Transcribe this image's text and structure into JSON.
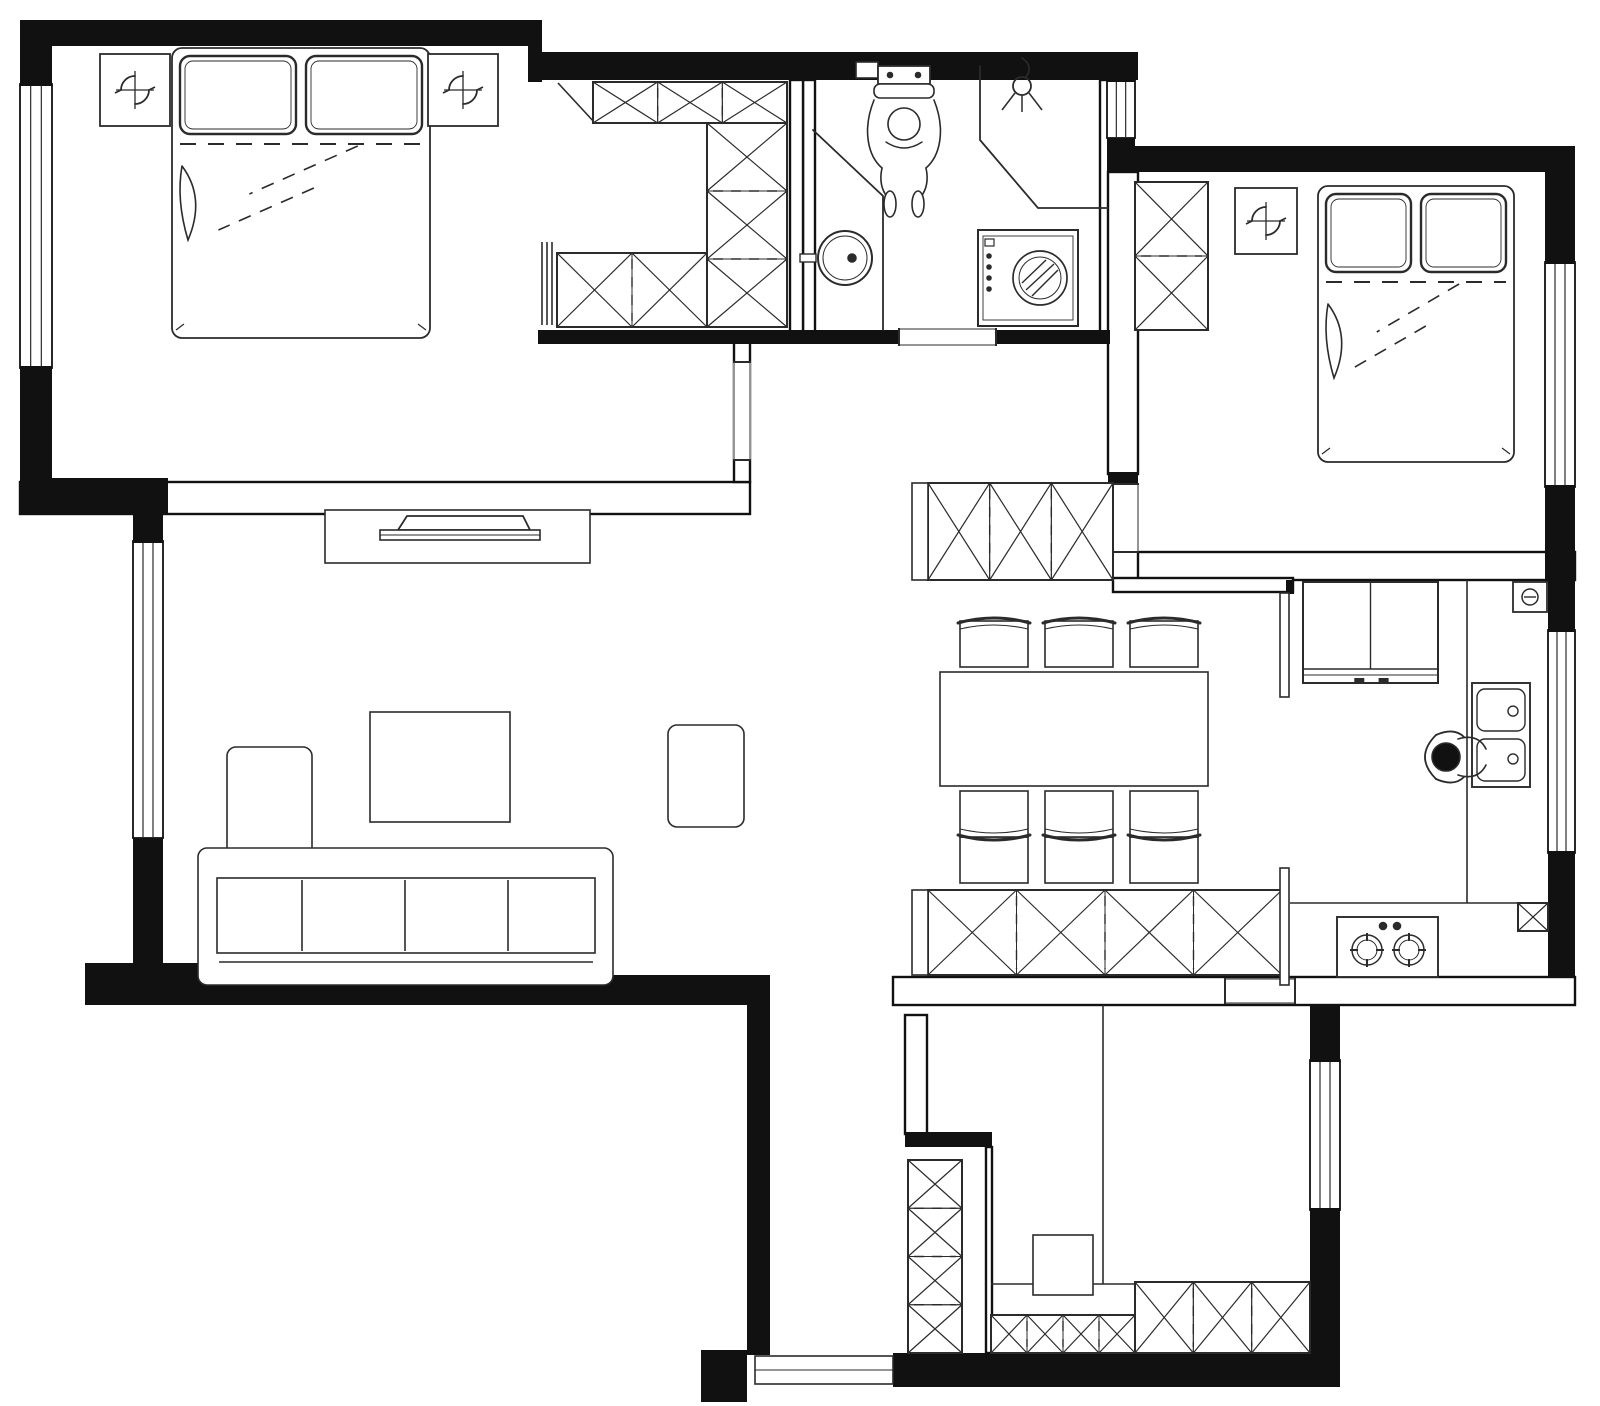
{
  "title": "apartment-floor-plan",
  "canvas": {
    "width": 1600,
    "height": 1406,
    "background": "#ffffff",
    "wall_color": "#111111",
    "line_color": "#2b2b2b",
    "sketch_color": "#333333"
  },
  "rooms": [
    {
      "name": "master-bedroom"
    },
    {
      "name": "walk-in-closet"
    },
    {
      "name": "bathroom"
    },
    {
      "name": "foyer"
    },
    {
      "name": "second-bedroom"
    },
    {
      "name": "living-room"
    },
    {
      "name": "dining-room"
    },
    {
      "name": "kitchen"
    },
    {
      "name": "corridor"
    },
    {
      "name": "study-room"
    }
  ],
  "elements": [
    {
      "n": "wall-bedroom1-south",
      "t": "hwall",
      "r": [
        20,
        482,
        730,
        32
      ]
    },
    {
      "n": "wall-bathroom-west",
      "t": "hwall",
      "r": [
        803,
        80,
        12,
        252
      ]
    },
    {
      "n": "wall-bathroom-east",
      "t": "hwall",
      "r": [
        1100,
        80,
        10,
        254
      ]
    },
    {
      "n": "wall-foyer-east",
      "t": "hwall",
      "r": [
        1108,
        172,
        30,
        302
      ]
    },
    {
      "n": "wall-bedroom2-south",
      "t": "hwall",
      "r": [
        1138,
        552,
        437,
        28
      ]
    },
    {
      "n": "wall-dining-north",
      "t": "hwall",
      "r": [
        1113,
        578,
        180,
        14
      ]
    },
    {
      "n": "wall-dining-south",
      "t": "hwall",
      "r": [
        893,
        977,
        682,
        28
      ]
    },
    {
      "n": "wall-corridor-east",
      "t": "hwall",
      "r": [
        905,
        1015,
        22,
        119
      ]
    },
    {
      "n": "wall-study-west",
      "t": "hwall",
      "r": [
        986,
        1147,
        6,
        206
      ]
    },
    {
      "n": "wall-closet-east",
      "t": "hwall",
      "r": [
        790,
        80,
        13,
        252
      ]
    },
    {
      "n": "wall-bedroom1-door-wall",
      "t": "hwall",
      "r": [
        734,
        342,
        16,
        140
      ]
    },
    {
      "n": "window-bedroom1-west",
      "t": "win",
      "r": [
        20,
        84,
        32,
        284
      ]
    },
    {
      "n": "window-living-west",
      "t": "win",
      "r": [
        133,
        541,
        30,
        297
      ]
    },
    {
      "n": "window-foyer-north",
      "t": "win",
      "r": [
        1107,
        80,
        28,
        58
      ]
    },
    {
      "n": "window-bedroom2-east",
      "t": "win",
      "r": [
        1545,
        262,
        30,
        225
      ]
    },
    {
      "n": "window-kitchen-east",
      "t": "win",
      "r": [
        1548,
        630,
        27,
        223
      ]
    },
    {
      "n": "window-study-east",
      "t": "win",
      "r": [
        1310,
        1060,
        30,
        150
      ]
    },
    {
      "n": "wall-top-1",
      "t": "wall",
      "r": [
        20,
        20,
        520,
        26
      ]
    },
    {
      "n": "wall-top-step",
      "t": "wall",
      "r": [
        528,
        20,
        14,
        62
      ]
    },
    {
      "n": "wall-top-2",
      "t": "wall",
      "r": [
        528,
        52,
        610,
        28
      ]
    },
    {
      "n": "wall-foyer-window-cap-n",
      "t": "wall",
      "r": [
        1107,
        72,
        28,
        10
      ]
    },
    {
      "n": "wall-foyer-window-cap-s",
      "t": "wall",
      "r": [
        1107,
        138,
        28,
        10
      ]
    },
    {
      "n": "wall-bedroom2-top",
      "t": "wall",
      "r": [
        1107,
        146,
        440,
        26
      ]
    },
    {
      "n": "wall-east-upper",
      "t": "wall",
      "r": [
        1545,
        146,
        30,
        118
      ]
    },
    {
      "n": "wall-east-mid",
      "t": "wall",
      "r": [
        1545,
        485,
        30,
        97
      ]
    },
    {
      "n": "wall-kitchen-east-1",
      "t": "wall",
      "r": [
        1548,
        580,
        27,
        52
      ]
    },
    {
      "n": "wall-kitchen-east-2",
      "t": "wall",
      "r": [
        1548,
        851,
        27,
        126
      ]
    },
    {
      "n": "wall-se-upper",
      "t": "wall",
      "r": [
        1310,
        1005,
        30,
        57
      ]
    },
    {
      "n": "wall-se-lower",
      "t": "wall",
      "r": [
        1310,
        1208,
        30,
        145
      ]
    },
    {
      "n": "wall-bottom",
      "t": "wall",
      "r": [
        893,
        1353,
        447,
        34
      ]
    },
    {
      "n": "wall-corridor-west",
      "t": "wall",
      "r": [
        747,
        1003,
        23,
        352
      ]
    },
    {
      "n": "wall-entry-stub",
      "t": "wall",
      "r": [
        701,
        1350,
        46,
        52
      ]
    },
    {
      "n": "wall-living-south-1",
      "t": "wall",
      "r": [
        85,
        963,
        362,
        42
      ]
    },
    {
      "n": "wall-living-south-2",
      "t": "wall",
      "r": [
        445,
        975,
        325,
        30
      ]
    },
    {
      "n": "wall-west-upper",
      "t": "wall",
      "r": [
        20,
        20,
        32,
        66
      ]
    },
    {
      "n": "wall-west-mid",
      "t": "wall",
      "r": [
        20,
        366,
        32,
        118
      ]
    },
    {
      "n": "wall-west-step",
      "t": "wall",
      "r": [
        20,
        478,
        148,
        36
      ]
    },
    {
      "n": "wall-living-west-pillar-n",
      "t": "wall",
      "r": [
        133,
        514,
        30,
        29
      ]
    },
    {
      "n": "wall-living-west-pillar-s",
      "t": "wall",
      "r": [
        133,
        838,
        30,
        127
      ]
    },
    {
      "n": "wall-hall-stub",
      "t": "wall",
      "r": [
        905,
        1132,
        87,
        15
      ]
    },
    {
      "n": "wall-bathroom-south-1",
      "t": "wall",
      "r": [
        538,
        330,
        361,
        14
      ]
    },
    {
      "n": "wall-bathroom-south-2",
      "t": "wall",
      "r": [
        996,
        330,
        114,
        14
      ]
    },
    {
      "n": "wall-foyer-pillar",
      "t": "wall",
      "r": [
        1108,
        472,
        30,
        12
      ]
    },
    {
      "n": "wall-kitchen-door-stub",
      "t": "wall",
      "r": [
        1286,
        580,
        8,
        14
      ]
    },
    {
      "n": "door-bedroom1",
      "t": "open",
      "r": [
        734,
        362,
        16,
        98
      ],
      "dir": "v"
    },
    {
      "n": "door-bathroom",
      "t": "open",
      "r": [
        899,
        329,
        97,
        16
      ],
      "dir": "h"
    },
    {
      "n": "door-bedroom2",
      "t": "open",
      "r": [
        1108,
        484,
        30,
        68
      ],
      "dir": "v"
    },
    {
      "n": "door-study",
      "t": "open",
      "r": [
        1225,
        979,
        70,
        24
      ],
      "dir": "h"
    },
    {
      "n": "door-entry-threshold",
      "t": "sill",
      "r": [
        755,
        1356,
        138,
        28
      ]
    },
    {
      "n": "partition-toilet",
      "t": "pline",
      "pts": [
        [
          813,
          130
        ],
        [
          883,
          196
        ],
        [
          883,
          330
        ]
      ]
    },
    {
      "n": "partition-shower",
      "t": "pline",
      "pts": [
        [
          980,
          66
        ],
        [
          980,
          140
        ],
        [
          1038,
          208
        ],
        [
          1108,
          208
        ]
      ]
    },
    {
      "n": "kitchen-counter-edge-vertical",
      "t": "line",
      "p": [
        1467,
        580,
        1467,
        903
      ]
    },
    {
      "n": "kitchen-counter-edge-horizontal",
      "t": "line",
      "p": [
        1290,
        903,
        1548,
        903
      ]
    },
    {
      "n": "study-divider-line",
      "t": "line",
      "p": [
        1103,
        1005,
        1103,
        1284
      ]
    },
    {
      "n": "study-shelf-line",
      "t": "line",
      "p": [
        991,
        1284,
        1135,
        1284
      ]
    },
    {
      "n": "closet-corner-diagonal",
      "t": "line",
      "p": [
        558,
        83,
        595,
        123
      ]
    },
    {
      "n": "closet-door-panel-1",
      "t": "line",
      "p": [
        542,
        242,
        542,
        325
      ]
    },
    {
      "n": "closet-door-panel-2",
      "t": "line",
      "p": [
        547,
        242,
        547,
        325
      ]
    },
    {
      "n": "closet-door-panel-3",
      "t": "line",
      "p": [
        552,
        242,
        552,
        325
      ]
    },
    {
      "n": "closet-top-cabinet",
      "t": "xcab",
      "r": [
        593,
        82,
        194,
        41
      ],
      "cells": 3,
      "dir": "h"
    },
    {
      "n": "closet-right-cabinet",
      "t": "xcab",
      "r": [
        707,
        123,
        80,
        204
      ],
      "cells": 3,
      "dir": "v"
    },
    {
      "n": "closet-bottom-cabinet",
      "t": "xcab",
      "r": [
        557,
        253,
        150,
        74
      ],
      "cells": 2,
      "dir": "h"
    },
    {
      "n": "wardrobe-bedroom2",
      "t": "xcab",
      "r": [
        1135,
        182,
        73,
        148
      ],
      "cells": 2,
      "dir": "v"
    },
    {
      "n": "shoe-cabinet",
      "t": "xcab",
      "r": [
        928,
        483,
        185,
        97
      ],
      "cells": 3,
      "dir": "h"
    },
    {
      "n": "shoe-cabinet-end-cap",
      "t": "box",
      "r": [
        912,
        483,
        16,
        97
      ]
    },
    {
      "n": "sideboard-cabinet",
      "t": "xcab",
      "r": [
        928,
        890,
        354,
        85
      ],
      "cells": 4,
      "dir": "h"
    },
    {
      "n": "sideboard-end-cap",
      "t": "box",
      "r": [
        912,
        890,
        16,
        85
      ]
    },
    {
      "n": "study-tall-cabinet",
      "t": "xcab",
      "r": [
        908,
        1160,
        54,
        193
      ],
      "cells": 4,
      "dir": "v"
    },
    {
      "n": "study-bottom-cabinet-left",
      "t": "xcab",
      "r": [
        991,
        1315,
        144,
        38
      ],
      "cells": 4,
      "dir": "h"
    },
    {
      "n": "study-bottom-cabinet-right",
      "t": "xcab",
      "r": [
        1135,
        1282,
        175,
        71
      ],
      "cells": 3,
      "dir": "h"
    },
    {
      "n": "kitchen-flue-duct",
      "t": "xcab",
      "r": [
        1518,
        903,
        30,
        28
      ],
      "cells": 1,
      "dir": "h"
    },
    {
      "n": "kitchen-door-panel-north",
      "t": "box",
      "r": [
        1280,
        593,
        9,
        104
      ]
    },
    {
      "n": "kitchen-door-panel-south",
      "t": "box",
      "r": [
        1280,
        868,
        9,
        117
      ]
    },
    {
      "n": "tv-console",
      "t": "box",
      "r": [
        325,
        510,
        265,
        53
      ]
    },
    {
      "n": "tv",
      "t": "sym",
      "s": "tv",
      "at": [
        460,
        514
      ]
    },
    {
      "n": "coffee-table",
      "t": "box",
      "r": [
        370,
        712,
        140,
        110
      ]
    },
    {
      "n": "side-table",
      "t": "rbox",
      "r": [
        668,
        725,
        76,
        102
      ]
    },
    {
      "n": "sofa-chaise",
      "t": "rbox",
      "r": [
        227,
        747,
        85,
        215
      ]
    },
    {
      "n": "sofa-frame",
      "t": "rbox",
      "r": [
        198,
        848,
        415,
        137
      ]
    },
    {
      "n": "sofa-seats",
      "t": "box",
      "r": [
        217,
        878,
        378,
        75
      ]
    },
    {
      "n": "sofa-seat-divider-1",
      "t": "line",
      "p": [
        302,
        880,
        302,
        951
      ]
    },
    {
      "n": "sofa-seat-divider-2",
      "t": "line",
      "p": [
        405,
        880,
        405,
        951
      ]
    },
    {
      "n": "sofa-seat-divider-3",
      "t": "line",
      "p": [
        508,
        880,
        508,
        951
      ]
    },
    {
      "n": "sofa-front-line",
      "t": "line",
      "p": [
        219,
        962,
        593,
        962
      ]
    },
    {
      "n": "dining-table",
      "t": "box",
      "r": [
        940,
        672,
        268,
        114
      ]
    },
    {
      "n": "dining-chair-1",
      "t": "sym",
      "s": "chair",
      "at": [
        994,
        644
      ],
      "face": "down"
    },
    {
      "n": "dining-chair-2",
      "t": "sym",
      "s": "chair",
      "at": [
        1079,
        644
      ],
      "face": "down"
    },
    {
      "n": "dining-chair-3",
      "t": "sym",
      "s": "chair",
      "at": [
        1164,
        644
      ],
      "face": "down"
    },
    {
      "n": "dining-chair-4",
      "t": "sym",
      "s": "chair",
      "at": [
        994,
        814
      ],
      "face": "up"
    },
    {
      "n": "dining-chair-5",
      "t": "sym",
      "s": "chair",
      "at": [
        1079,
        814
      ],
      "face": "up"
    },
    {
      "n": "dining-chair-6",
      "t": "sym",
      "s": "chair",
      "at": [
        1164,
        814
      ],
      "face": "up"
    },
    {
      "n": "bed-master",
      "t": "sym",
      "s": "bed",
      "r": [
        172,
        48,
        258,
        290
      ]
    },
    {
      "n": "bed-second",
      "t": "sym",
      "s": "bed",
      "r": [
        1318,
        186,
        196,
        276
      ]
    },
    {
      "n": "ac-unit-master-left",
      "t": "sym",
      "s": "fan",
      "r": [
        100,
        54,
        70,
        72
      ]
    },
    {
      "n": "ac-unit-master-right",
      "t": "sym",
      "s": "fan",
      "r": [
        428,
        54,
        70,
        72
      ]
    },
    {
      "n": "ac-unit-bedroom2",
      "t": "sym",
      "s": "fan",
      "r": [
        1235,
        188,
        62,
        66
      ]
    },
    {
      "n": "toilet-cistern-box",
      "t": "box",
      "r": [
        856,
        62,
        22,
        16
      ]
    },
    {
      "n": "toilet-with-person",
      "t": "sym",
      "s": "toilet",
      "at": [
        904,
        128
      ]
    },
    {
      "n": "shower-head",
      "t": "sym",
      "s": "shower",
      "at": [
        1022,
        86
      ]
    },
    {
      "n": "bathroom-round-sink",
      "t": "sym",
      "s": "rsink",
      "at": [
        845,
        258
      ]
    },
    {
      "n": "washing-machine",
      "t": "sym",
      "s": "washer",
      "r": [
        978,
        230,
        100,
        96
      ]
    },
    {
      "n": "fridge",
      "t": "sym",
      "s": "fridge",
      "r": [
        1303,
        582,
        135,
        101
      ]
    },
    {
      "n": "kitchen-sink",
      "t": "sym",
      "s": "ksink",
      "r": [
        1472,
        683,
        58,
        104
      ]
    },
    {
      "n": "person-at-sink",
      "t": "sym",
      "s": "person",
      "at": [
        1448,
        757
      ]
    },
    {
      "n": "gas-stove",
      "t": "sym",
      "s": "stove",
      "r": [
        1337,
        917,
        101,
        60
      ]
    },
    {
      "n": "water-heater",
      "t": "sym",
      "s": "heater",
      "r": [
        1513,
        582,
        34,
        30
      ]
    },
    {
      "n": "study-desk",
      "t": "box",
      "r": [
        1033,
        1235,
        60,
        60
      ]
    }
  ]
}
